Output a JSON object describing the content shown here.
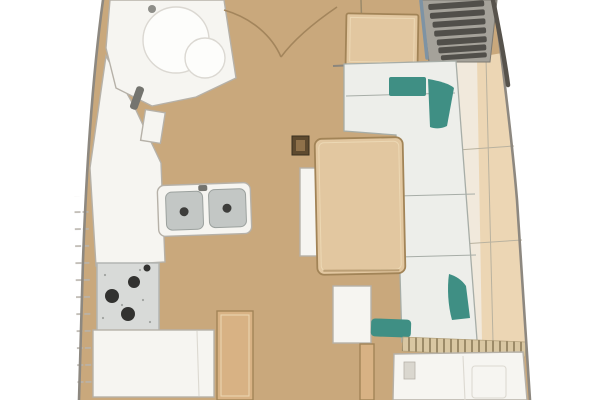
{
  "scene": {
    "type": "floor-plan",
    "subject": "Sailboat interior floor plan (top-down): saloon, galley, head and companionway",
    "regions": {
      "head": "Head compartment with round wash basin (top left)",
      "galley": "Port-side galley with double sink, three-burner stove and white lockers",
      "saloon": "Saloon table with mast compression post and L-shaped settee with teal cushions",
      "companionway": "Companionway steps with dark treads (top right)",
      "shelf": "Starboard hull-side shelf and locker band",
      "aft": "Aft section with slatted hatch, wood trim and white desk/berth (bottom right)"
    }
  },
  "colors": {
    "outside": "#ffffff",
    "floor": "#c9a87c",
    "hull_line": "#8d8880",
    "hull_line_dark": "#57534c",
    "tick": "#b8b3ab",
    "white_furniture": "#f6f5f1",
    "furniture_stroke": "#b6b1a8",
    "detail_line": "#dcd9d1",
    "wood": "#d8b284",
    "wood_light": "#e2c7a0",
    "wood_stroke": "#a28457",
    "wood_inner": "#ecd8b4",
    "cushion": "#edeeea",
    "cushion_seam": "#a7ada7",
    "teal": "#3f8f84",
    "stairs_bg": "#a5a29a",
    "stair_tread": "#514f4a",
    "stair_rail": "#7e93a4",
    "sink_grey": "#c3c7c5",
    "sink_drain": "#3d3d3b",
    "stove_bg": "#d8dad8",
    "burner": "#323230",
    "slat_band": "#d9c7a2",
    "slat_line": "#8d7c5a",
    "arc_line": "#a3855c",
    "post_dark": "#5e4a2f",
    "post_light": "#8f714a",
    "shelf_left": "#f1e9dc",
    "shelf_right": "#ecd6b4",
    "shelf_seam": "#b9b29f",
    "basin": "#fdfdfb"
  }
}
